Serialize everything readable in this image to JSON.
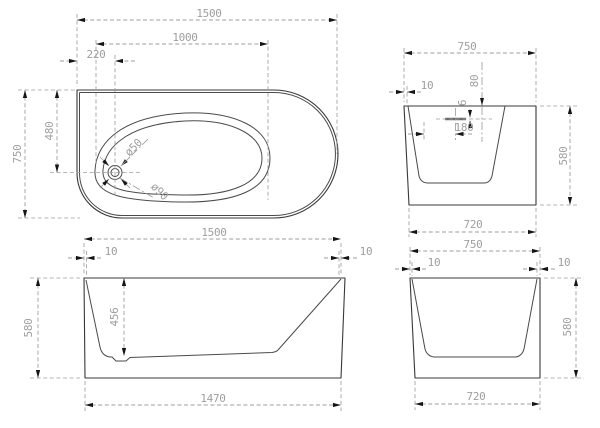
{
  "drawing": {
    "plan": {
      "overall_length": "1500",
      "inner_length": "1000",
      "drain_offset_x": "220",
      "overall_width": "750",
      "drain_offset_y": "480",
      "drain_small_dia": "ø50",
      "drain_large_dia": "ø90"
    },
    "end_view_top": {
      "top_width": "750",
      "wall_thickness": "10",
      "drain_depth": "80",
      "drain_gap": "6",
      "drain_position": "180",
      "height": "580",
      "base_width": "720"
    },
    "front_view": {
      "top_length": "1500",
      "wall_left": "10",
      "wall_right": "10",
      "height": "580",
      "inner_depth": "456",
      "base_length": "1470"
    },
    "end_view_bottom": {
      "top_width": "750",
      "wall_left": "10",
      "wall_right": "10",
      "height": "580",
      "base_width": "720"
    }
  }
}
